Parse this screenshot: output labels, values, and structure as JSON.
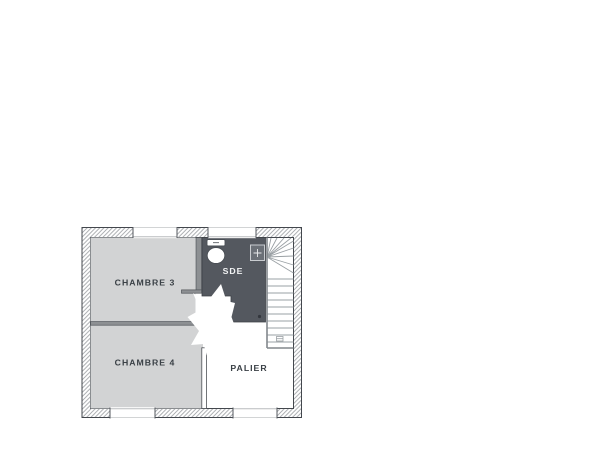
{
  "plan": {
    "type": "floor-plan",
    "floor": "upper-floor",
    "rooms": [
      {
        "id": "chambre-3",
        "label": "CHAMBRE 3",
        "fill": "#d2d3d4"
      },
      {
        "id": "chambre-4",
        "label": "CHAMBRE 4",
        "fill": "#d2d3d4"
      },
      {
        "id": "sde",
        "label": "SDE",
        "fill": "#54585f"
      },
      {
        "id": "palier",
        "label": "PALIER",
        "fill": "#ffffff"
      }
    ],
    "fixtures": [
      {
        "icon": "toilet-icon",
        "room": "sde"
      },
      {
        "icon": "washbasin-icon",
        "room": "sde"
      },
      {
        "icon": "drain-icon",
        "room": "sde"
      }
    ],
    "stairs": {
      "icon": "staircase-icon",
      "winder_steps": 9,
      "straight_steps": 10
    },
    "windows": {
      "top_wall": 2,
      "bottom_wall": 2
    },
    "colors": {
      "room_fill": "#d2d3d4",
      "sde_fill": "#54585f",
      "wall_outline": "#43474d",
      "hatch_line": "#a0a3a7",
      "partition_fill": "#8d9093",
      "stair_line": "#9aa0a4",
      "stair_edge": "#82878c",
      "label_text": "#3a4046",
      "label_text_on_dark": "#f2f3f4",
      "background": "#ffffff"
    }
  }
}
